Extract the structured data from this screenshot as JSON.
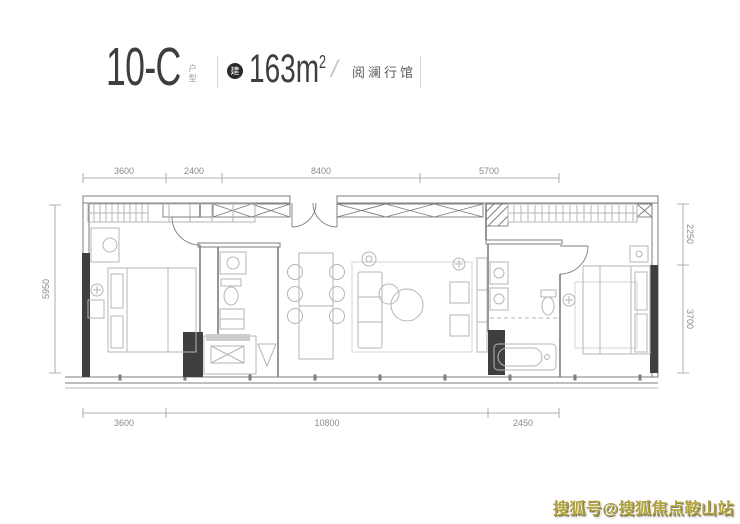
{
  "header": {
    "unit_code": "10-C",
    "unit_type_label": "户型",
    "area_badge": "建",
    "area_value": "163",
    "area_unit_base": "m",
    "area_unit_sup": "2",
    "divider": "/",
    "project_name": "阅澜行馆"
  },
  "plan": {
    "dims": {
      "top": [
        "3600",
        "2400",
        "8400",
        "5700"
      ],
      "bottom": [
        "3600",
        "10800",
        "2450"
      ],
      "right": [
        "2250",
        "3700"
      ],
      "left": [
        "5950"
      ]
    },
    "colors": {
      "wall_dark": "#3f3f3f",
      "wall_line": "#7d7d7d",
      "furniture_line": "#b5b5b5",
      "dim_line": "#9a9a9a"
    }
  },
  "watermark": {
    "text": "搜狐号@搜狐焦点鞍山站",
    "color": "#b0a23e"
  }
}
